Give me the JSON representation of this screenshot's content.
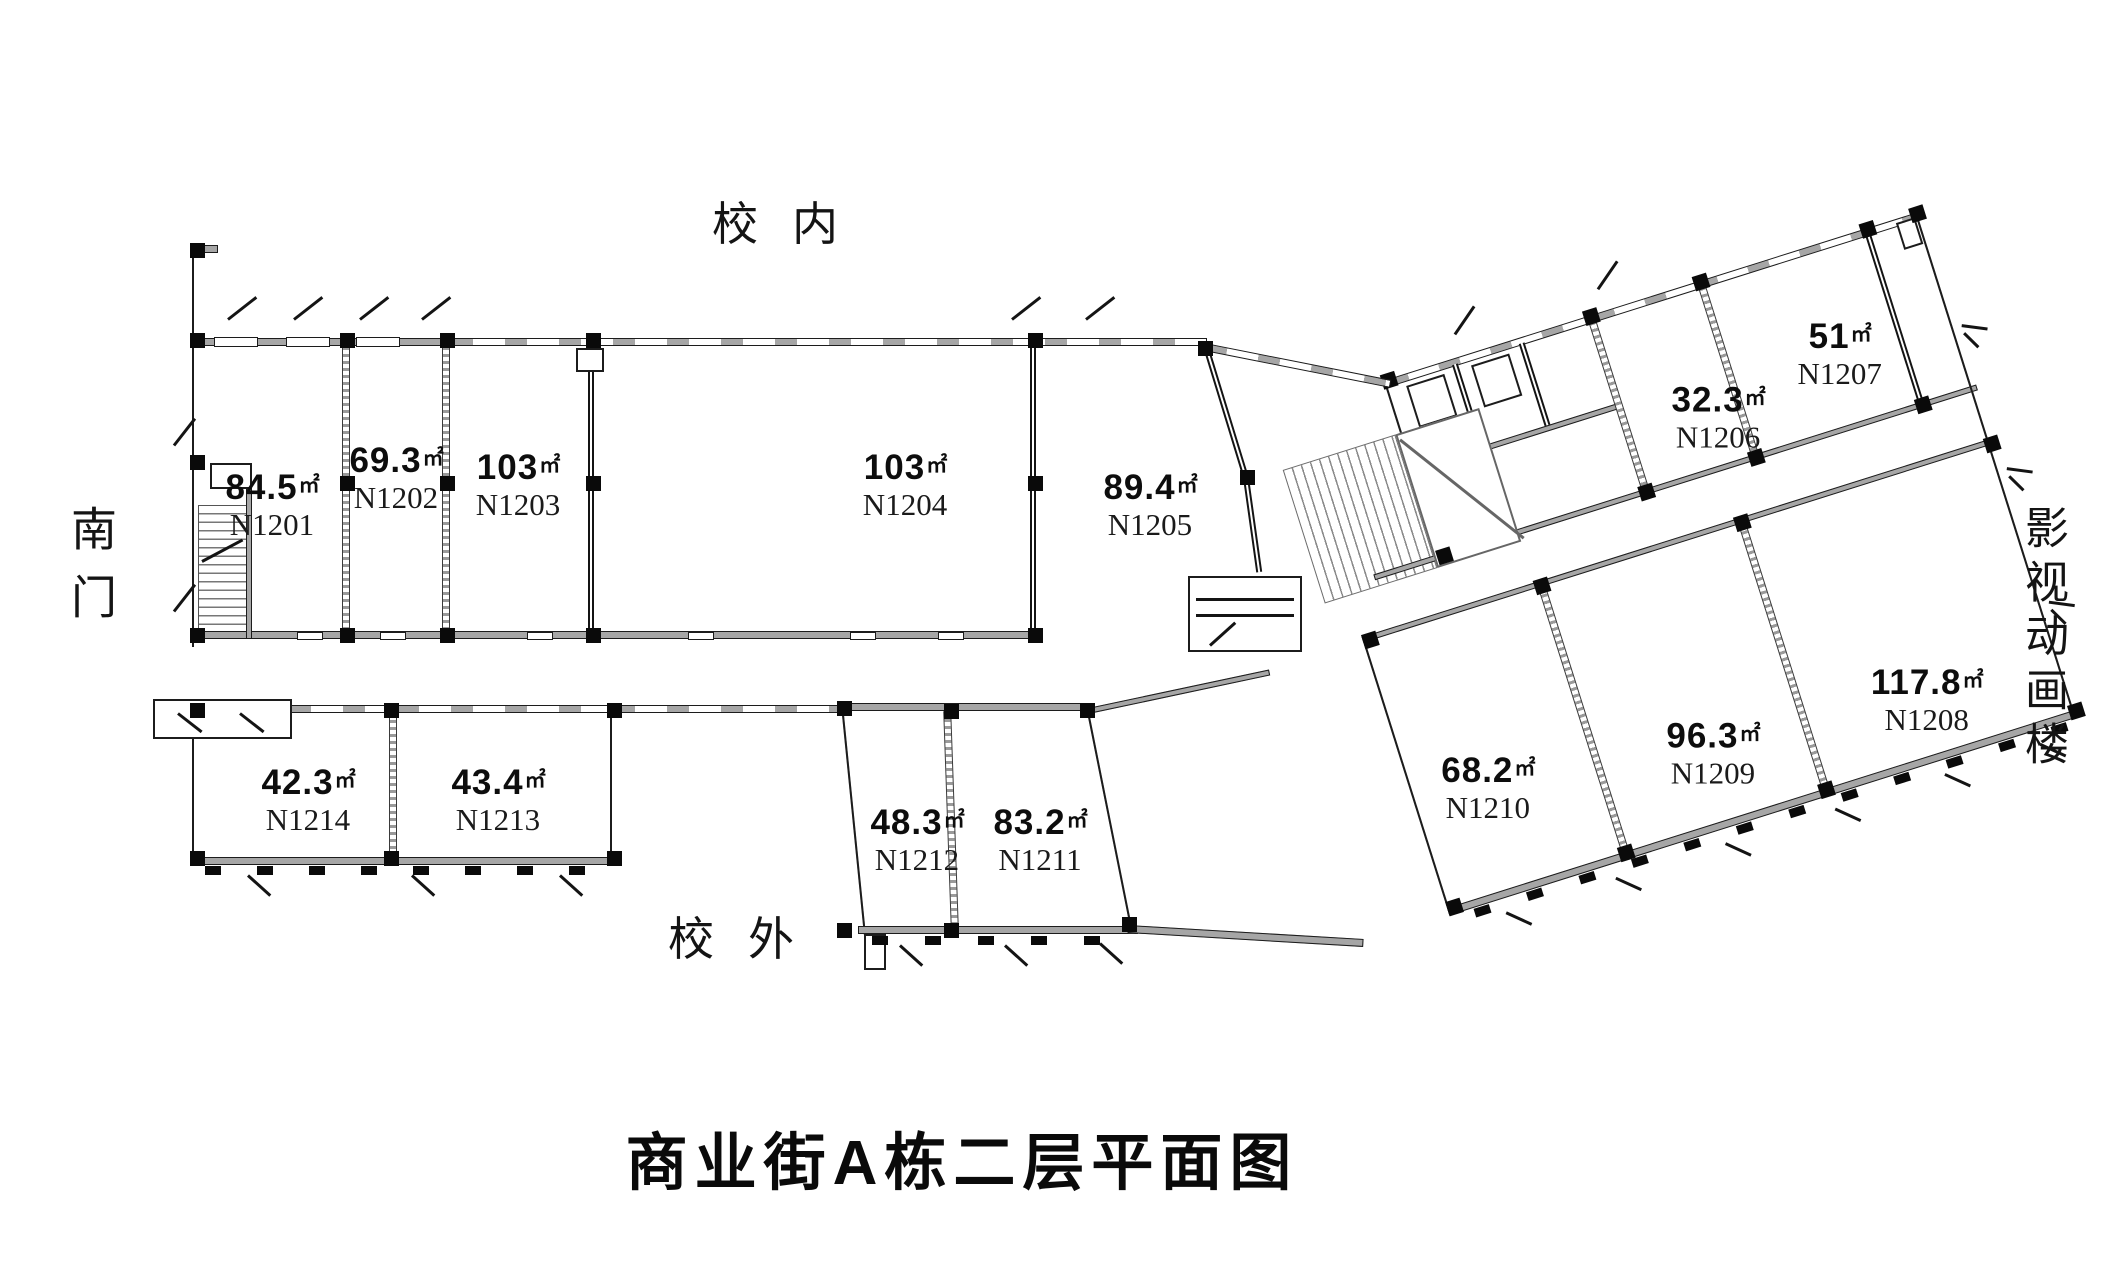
{
  "title": "商业街A栋二层平面图",
  "area_unit": "㎡",
  "context": {
    "top": "校内",
    "bottom": "校外",
    "left": "南门",
    "right": "影视动画楼"
  },
  "rooms": [
    {
      "code": "N1201",
      "area": "84.5"
    },
    {
      "code": "N1202",
      "area": "69.3"
    },
    {
      "code": "N1203",
      "area": "103"
    },
    {
      "code": "N1204",
      "area": "103"
    },
    {
      "code": "N1205",
      "area": "89.4"
    },
    {
      "code": "N1206",
      "area": "32.3"
    },
    {
      "code": "N1207",
      "area": "51"
    },
    {
      "code": "N1208",
      "area": "117.8"
    },
    {
      "code": "N1209",
      "area": "96.3"
    },
    {
      "code": "N1210",
      "area": "68.2"
    },
    {
      "code": "N1211",
      "area": "83.2"
    },
    {
      "code": "N1212",
      "area": "48.3"
    },
    {
      "code": "N1213",
      "area": "43.4"
    },
    {
      "code": "N1214",
      "area": "42.3"
    }
  ]
}
